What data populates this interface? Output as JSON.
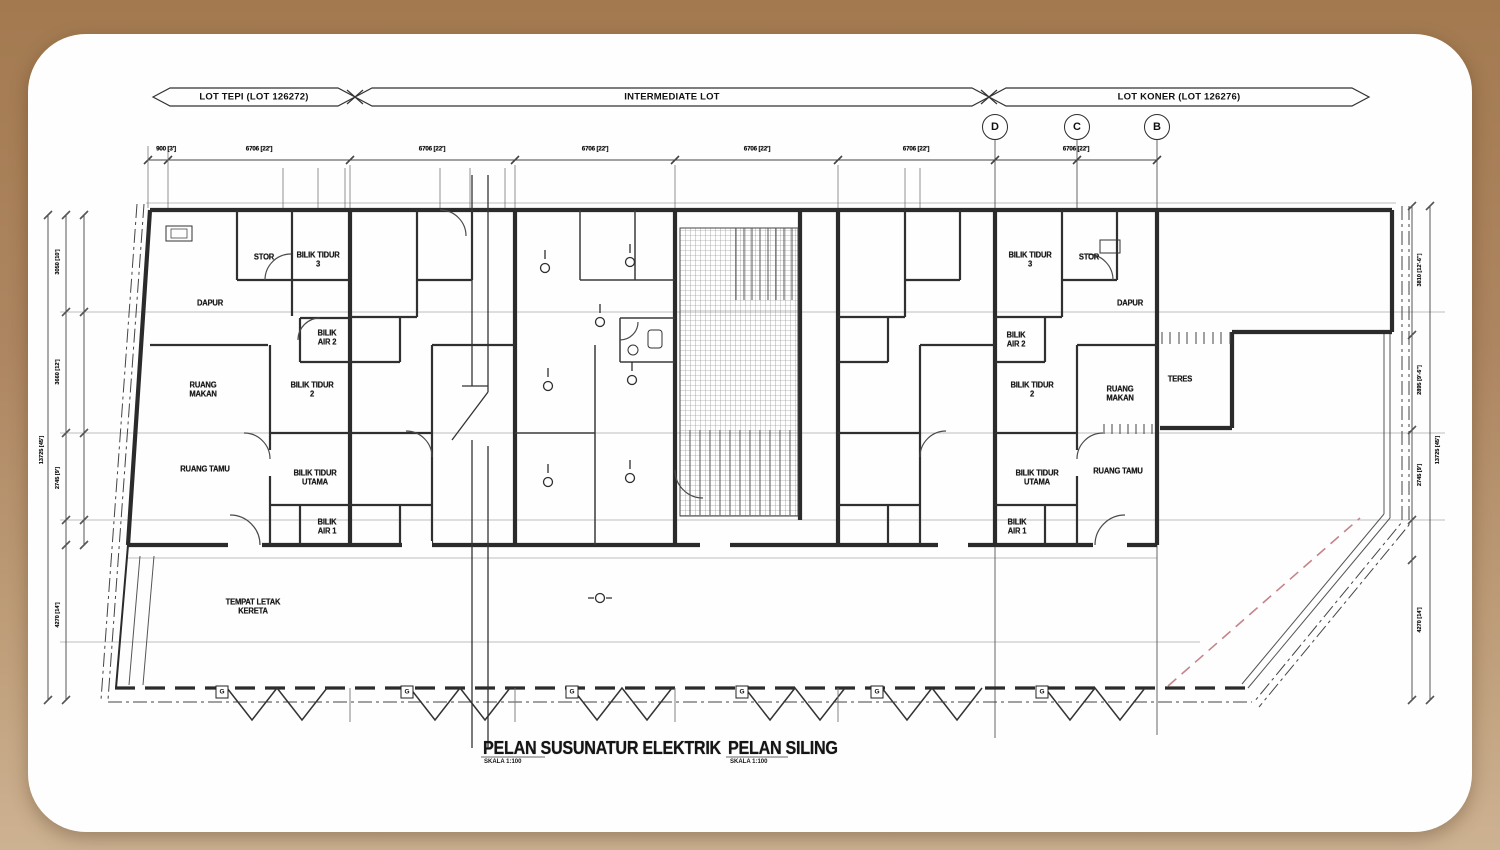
{
  "colors": {
    "background_top": "#a67d53",
    "background_bottom": "#cdb292",
    "paper": "#fefefe",
    "ink": "#2d2d2d",
    "light_line": "#9a9a9a",
    "red_dashed": "#c4848a"
  },
  "banners": {
    "left": "LOT TEPI (LOT 126272)",
    "middle": "INTERMEDIATE LOT",
    "right": "LOT KONER (LOT 126276)"
  },
  "grid_bubbles": {
    "d": "D",
    "c": "C",
    "b": "B"
  },
  "top_dims": [
    "900 [3']",
    "6706 [22']",
    "6706 [22']",
    "6706 [22']",
    "6706 [22']",
    "6706 [22']",
    "6706 [22']"
  ],
  "left_dims": {
    "overall": "13725 [45']",
    "segments": [
      "3050 [10']",
      "3660 [12']",
      "2745 [9']",
      "4270 [14']"
    ]
  },
  "right_dims": {
    "overall": "13725 [45']",
    "segments": [
      "3810 [12'-6\"]",
      "2895 [9'-6\"]",
      "2745 [9']",
      "4270 [14']"
    ]
  },
  "rooms_left": {
    "stor": "STOR",
    "bilik_tidur_3": "BILIK TIDUR\n3",
    "dapur": "DAPUR",
    "bilik_air_2": "BILIK\nAIR 2",
    "ruang_makan": "RUANG\nMAKAN",
    "bilik_tidur_2": "BILIK TIDUR\n2",
    "ruang_tamu": "RUANG TAMU",
    "bilik_tidur_utama": "BILIK TIDUR\nUTAMA",
    "bilik_air_1": "BILIK\nAIR 1",
    "tempat_letak_kereta": "TEMPAT LETAK\nKERETA"
  },
  "rooms_right": {
    "bilik_tidur_3": "BILIK TIDUR\n3",
    "stor": "STOR",
    "dapur": "DAPUR",
    "bilik_air_2": "BILIK\nAIR 2",
    "bilik_tidur_2": "BILIK TIDUR\n2",
    "ruang_makan": "RUANG\nMAKAN",
    "teres": "TERES",
    "bilik_tidur_utama": "BILIK TIDUR\nUTAMA",
    "ruang_tamu": "RUANG TAMU",
    "bilik_air_1": "BILIK\nAIR 1"
  },
  "gutter_box_label": "G",
  "titles": {
    "electrical": "PELAN SUSUNATUR ELEKTRIK",
    "electrical_scale": "SKALA 1:100",
    "ceiling": "PELAN SILING",
    "ceiling_scale": "SKALA 1:100"
  }
}
